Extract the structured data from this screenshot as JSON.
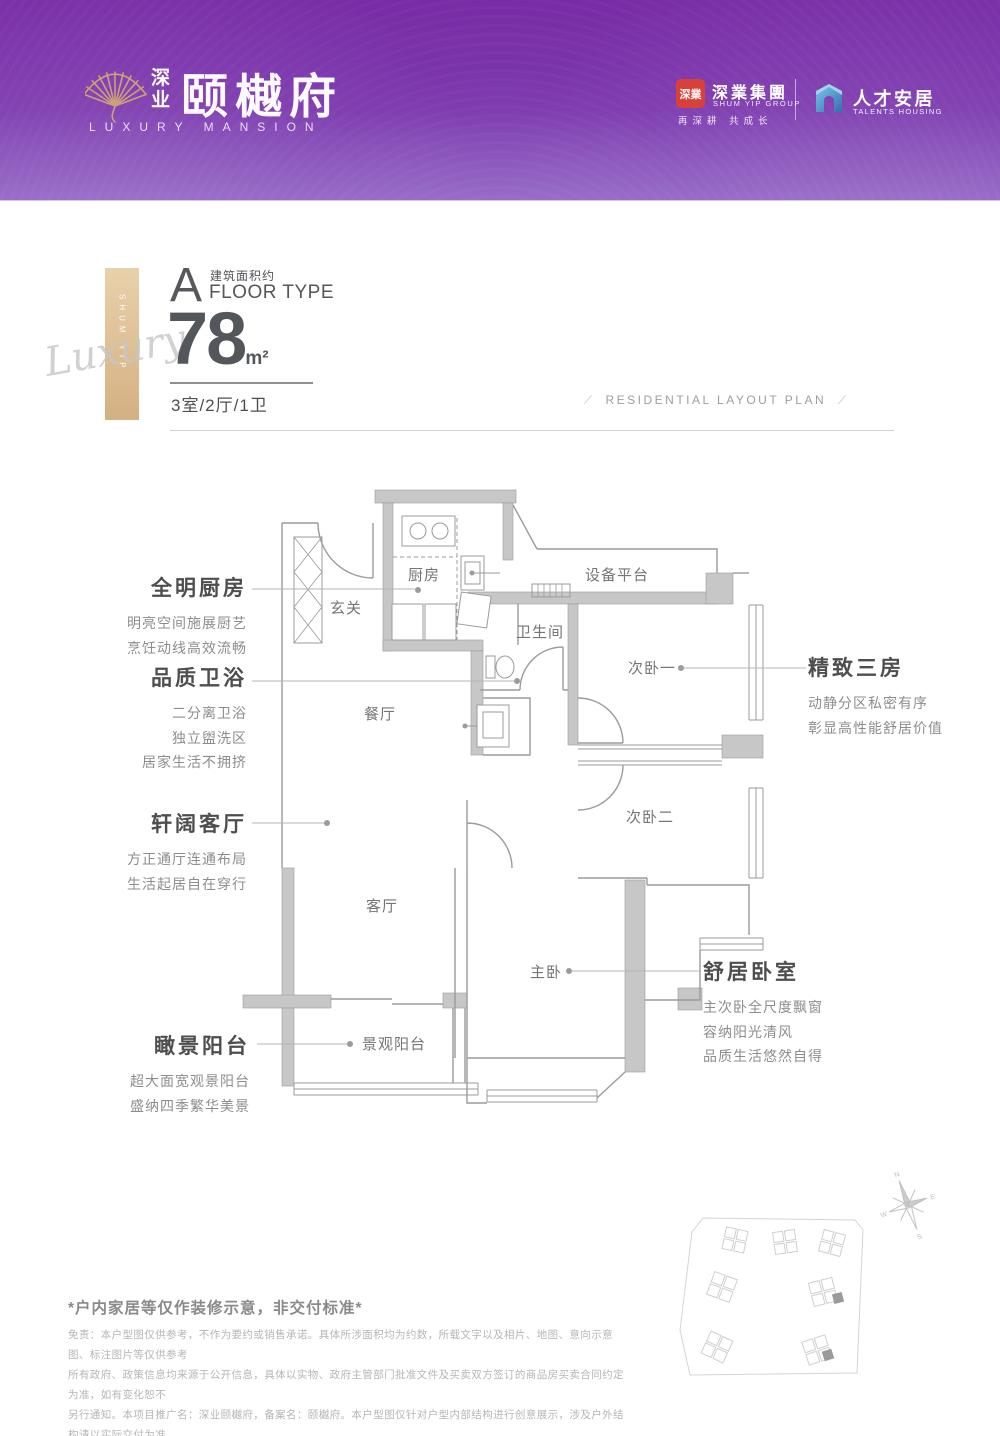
{
  "header": {
    "brand": {
      "prefix": "深业",
      "name": "颐樾府",
      "tagline": "LUXURY MANSION"
    },
    "shumyip": {
      "seal": "深業",
      "cn": "深業集團",
      "en": "SHUM YIP GROUP",
      "slogan": "再深耕 共成长"
    },
    "talents": {
      "cn": "人才安居",
      "en": "TALENTS HOUSING"
    }
  },
  "floor": {
    "letter": "A",
    "area_approx": "建筑面积约",
    "floor_type": "FLOOR TYPE",
    "area": "78",
    "unit": "m²",
    "rooms": "3室/2厅/1卫",
    "plan_en": "RESIDENTIAL LAYOUT PLAN",
    "slash": "/",
    "ribbon_vertical": "SHUM YIP",
    "ribbon_script": "Luxury"
  },
  "rooms": {
    "entry": "玄关",
    "kitchen": "厨房",
    "dining": "餐厅",
    "platform": "设备平台",
    "bath": "卫生间",
    "bed1": "次卧一",
    "bed2": "次卧二",
    "living": "客厅",
    "master": "主卧",
    "balcony": "景观阳台"
  },
  "callouts": {
    "kitchen": {
      "title": "全明厨房",
      "lines": [
        "明亮空间施展厨艺",
        "烹饪动线高效流畅"
      ]
    },
    "bath": {
      "title": "品质卫浴",
      "lines": [
        "二分离卫浴",
        "独立盥洗区",
        "居家生活不拥挤"
      ]
    },
    "living": {
      "title": "轩阔客厅",
      "lines": [
        "方正通厅连通布局",
        "生活起居自在穿行"
      ]
    },
    "balcony": {
      "title": "瞰景阳台",
      "lines": [
        "超大面宽观景阳台",
        "盛纳四季繁华美景"
      ]
    },
    "bedrooms": {
      "title": "精致三房",
      "lines": [
        "动静分区私密有序",
        "彰显高性能舒居价值"
      ]
    },
    "master": {
      "title": "舒居卧室",
      "lines": [
        "主次卧全尺度飘窗",
        "容纳阳光清风",
        "品质生活悠然自得"
      ]
    }
  },
  "compass": {
    "n": "N",
    "e": "E",
    "s": "S",
    "w": "W"
  },
  "footer": {
    "note": "*户内家居等仅作装修示意，非交付标准*",
    "lines": [
      "免责：本户型图仅供参考，不作为要约或销售承诺。具体所涉面积均为约数，所载文字以及相片、地图、意向示意图、标注图片等仅供参考",
      "所有政府、政策信息均来源于公开信息，具体以实物、政府主管部门批准文件及买卖双方签订的商品房买卖合同约定为准，如有变化恕不",
      "另行通知。本项目推广名：深业颐樾府，备案名：颐樾府。本户型图仅针对户型内部结构进行创意展示，涉及户外结构请以实际交付为准。",
      "制作日期：2023年3月，后续资料如有更改，请以最新信息为准。"
    ]
  },
  "colors": {
    "purple_top": "#782ba6",
    "purple_bottom": "#9063c4",
    "gold": "#d8b88e",
    "seal_red": "#d8403a",
    "talents_blue": "#3e8fd0",
    "wall_gray": "#c7c7c7",
    "line_gray": "#9b9b9b",
    "text_dark": "#53565a"
  }
}
